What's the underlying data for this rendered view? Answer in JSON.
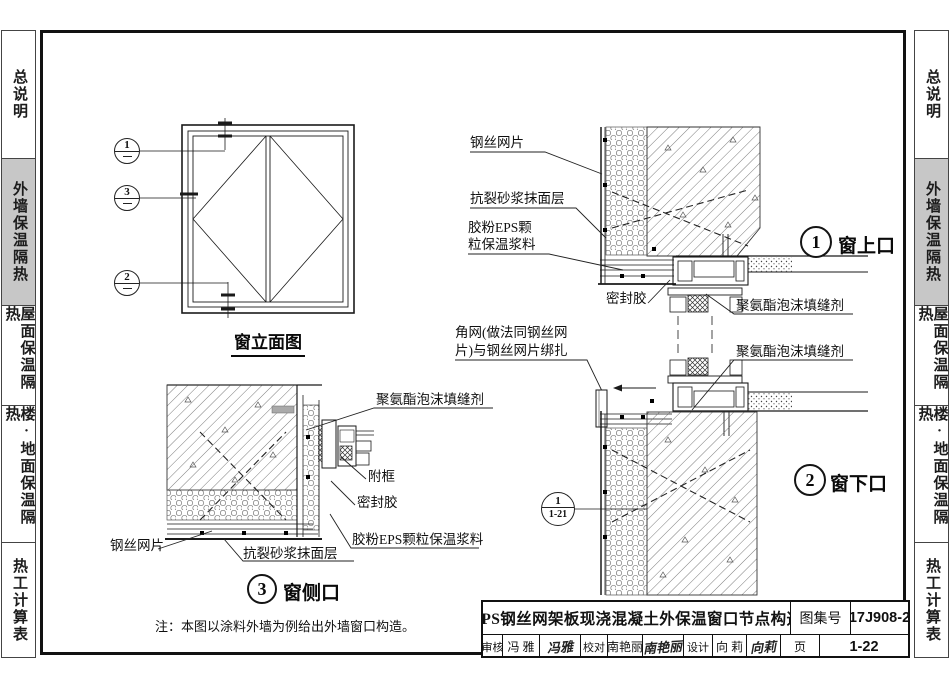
{
  "sidebar": {
    "tabs": [
      {
        "label": "总说明",
        "active": false
      },
      {
        "label": "外墙保温隔热",
        "active": true
      },
      {
        "label": "屋面保温隔热",
        "active": false
      },
      {
        "label": "楼·地面保温隔热",
        "active": false
      },
      {
        "label": "热工计算表",
        "active": false
      }
    ]
  },
  "elevation": {
    "caption": "窗立面图",
    "bubble1": "1",
    "bubble3": "3",
    "bubble2": "2"
  },
  "details": {
    "d1": {
      "num": "1",
      "name": "窗上口"
    },
    "d2": {
      "num": "2",
      "name": "窗下口"
    },
    "d3": {
      "num": "3",
      "name": "窗侧口"
    }
  },
  "ref_bubble": {
    "num": "1",
    "sheet": "1-21"
  },
  "labels": {
    "d1_mesh": "钢丝网片",
    "d1_render": "抗裂砂浆抹面层",
    "d1_eps_line1": "胶粉EPS颗",
    "d1_eps_line2": "粒保温浆料",
    "d1_sealant": "密封胶",
    "d1_foam": "聚氨酯泡沫填缝剂",
    "corner_mesh_line1": "角网(做法同钢丝网",
    "corner_mesh_line2": "片)与钢丝网片绑扎",
    "d2_foam": "聚氨酯泡沫填缝剂",
    "d3_foam": "聚氨酯泡沫填缝剂",
    "d3_subframe": "附框",
    "d3_sealant": "密封胶",
    "d3_eps": "胶粉EPS颗粒保温浆料",
    "d3_mesh": "钢丝网片",
    "d3_render": "抗裂砂浆抹面层"
  },
  "note": "注：本图以涂料外墙为例给出外墙窗口构造。",
  "titleblock": {
    "title": "EPS钢丝网架板现浇混凝土外保温窗口节点构造",
    "atlas_label": "图集号",
    "atlas_no": "17J908-2",
    "review_label": "审核",
    "reviewer": "冯 雅",
    "reviewer_sig": "冯雅",
    "check_label": "校对",
    "checker": "南艳丽",
    "checker_sig": "南艳丽",
    "design_label": "设计",
    "designer": "向 莉",
    "designer_sig": "向莉",
    "page_label": "页",
    "page_no": "1-22"
  }
}
